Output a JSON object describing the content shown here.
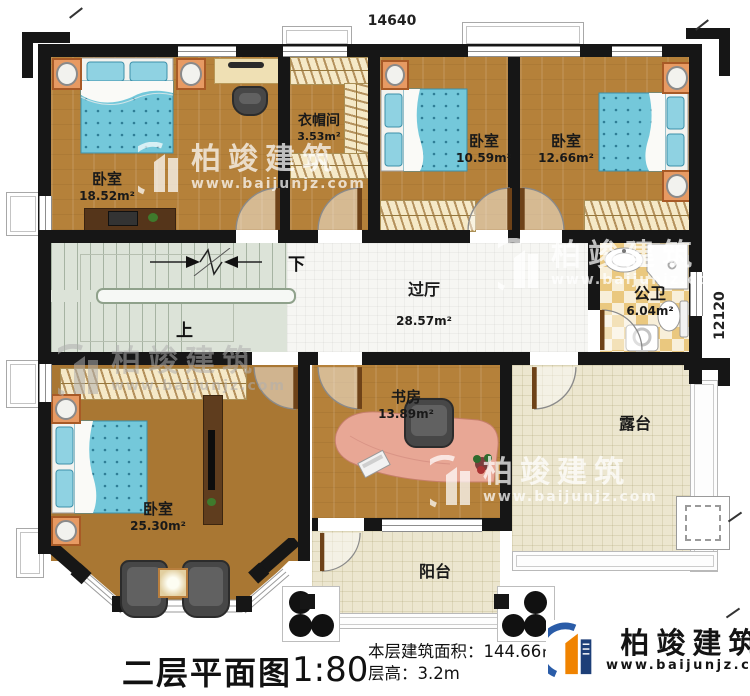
{
  "caption": {
    "title": "二层平面图",
    "scale": "1:80",
    "area_label": "本层建筑面积：",
    "area_value": "144.66㎡",
    "height_label": "层高：",
    "height_value": "3.2m"
  },
  "dimensions": {
    "top": "14640",
    "right": "12120"
  },
  "rooms": {
    "bedroom_tl": {
      "name": "卧室",
      "area": "18.52m²"
    },
    "cloakroom": {
      "name": "衣帽间",
      "area": "3.53m²"
    },
    "bedroom_tm": {
      "name": "卧室",
      "area": "10.59m²"
    },
    "bedroom_tr": {
      "name": "卧室",
      "area": "12.66m²"
    },
    "hall": {
      "name": "过厅",
      "area": "28.57m²"
    },
    "bathroom": {
      "name": "公卫",
      "area": "6.04m²"
    },
    "study": {
      "name": "书房",
      "area": "13.89m²"
    },
    "bedroom_bl": {
      "name": "卧室",
      "area": "25.30m²"
    },
    "terrace": {
      "name": "露台"
    },
    "balcony": {
      "name": "阳台"
    }
  },
  "stairs": {
    "down_label": "下",
    "up_label": "上"
  },
  "brand": {
    "name": "柏竣建筑",
    "website": "www.baijunjz.com"
  },
  "colors": {
    "wall": "#161616",
    "wood_floor": "#b5813a",
    "stair_floor": "#dce3d8",
    "bath_tile": "#eac87f",
    "terrace_tile": "#ece6cf",
    "bed_fabric": "#74c8da",
    "brand_orange": "#f08300",
    "brand_blue": "#2a5ca8"
  }
}
